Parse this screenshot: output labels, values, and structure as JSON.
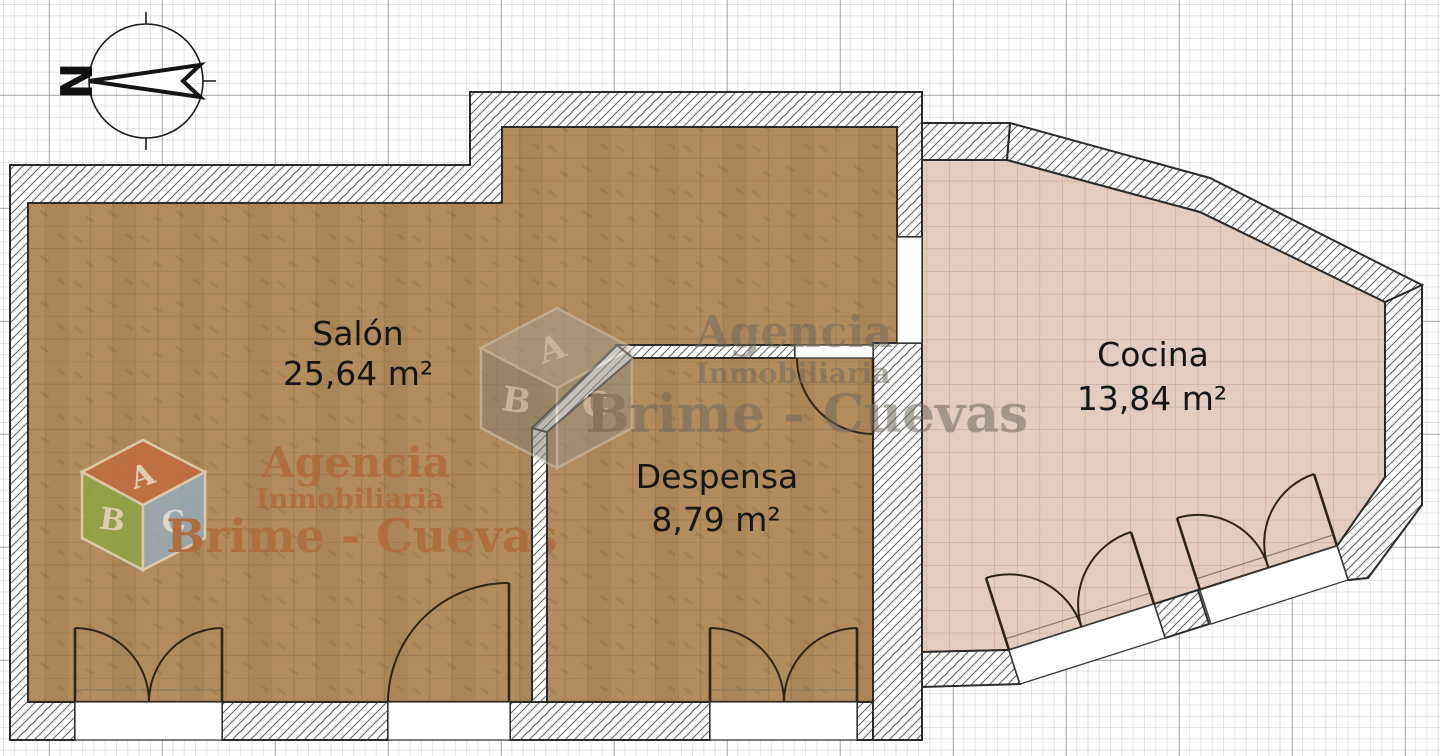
{
  "plan": {
    "rooms": [
      {
        "name": "Salón",
        "area": "25,64 m²"
      },
      {
        "name": "Despensa",
        "area": "8,79 m²"
      },
      {
        "name": "Cocina",
        "area": "13,84 m²"
      }
    ],
    "compass": {
      "letter": "N"
    },
    "watermark": {
      "line1": "Agencia",
      "line2": "Inmobiliaria",
      "line3": "Brime - Cuevas",
      "cube_letters": [
        "A",
        "B",
        "C"
      ]
    },
    "colors": {
      "parquet_floor": "#b28c5c",
      "tile_floor": "#e3cdc1",
      "watermark_orange": "#b06a3a",
      "watermark_gray": "#6f6a5e"
    }
  }
}
